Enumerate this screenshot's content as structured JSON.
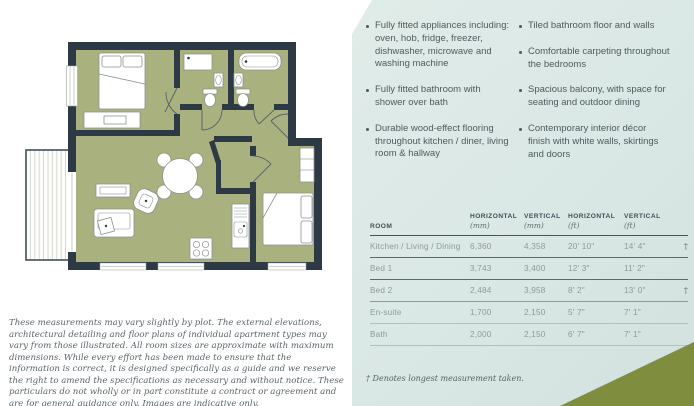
{
  "colors": {
    "panel_bg": "#dbe8e6",
    "olive_accent": "#7e8e3e",
    "wall": "#2d3944",
    "floor_green": "#a9b17e",
    "text_dark": "#4d5b5e",
    "text_muted": "#8d9a9a"
  },
  "panel": {
    "bullets_left": [
      "Fully fitted appliances including: oven, hob, fridge, freezer, dishwasher, microwave and washing machine",
      "Fully fitted bathroom with shower over bath",
      "Durable wood-effect flooring throughout kitchen / diner, living room & hallway"
    ],
    "bullets_right": [
      "Tiled bathroom floor and walls",
      "Comfortable carpeting throughout the bedrooms",
      "Spacious balcony, with space for seating and outdoor dining",
      "Contemporary interior décor finish with white walls, skirtings and doors"
    ],
    "table": {
      "headers": [
        {
          "label": "ROOM",
          "unit": ""
        },
        {
          "label": "HORIZONTAL",
          "unit": "(mm)"
        },
        {
          "label": "VERTICAL",
          "unit": "(mm)"
        },
        {
          "label": "HORIZONTAL",
          "unit": "(ft)"
        },
        {
          "label": "VERTICAL",
          "unit": "(ft)"
        }
      ],
      "rows": [
        {
          "room": "Kitchen / Living / Dining",
          "h_mm": "6,360",
          "v_mm": "4,358",
          "h_ft": "20' 10\"",
          "v_ft": "14' 4\"",
          "dagger": "†"
        },
        {
          "room": "Bed 1",
          "h_mm": "3,743",
          "v_mm": "3,400",
          "h_ft": "12' 3\"",
          "v_ft": "11' 2\"",
          "dagger": ""
        },
        {
          "room": "Bed 2",
          "h_mm": "2,484",
          "v_mm": "3,958",
          "h_ft": "8' 2\"",
          "v_ft": "13' 0\"",
          "dagger": "†"
        },
        {
          "room": "En-suite",
          "h_mm": "1,700",
          "v_mm": "2,150",
          "h_ft": "5' 7\"",
          "v_ft": "7' 1\"",
          "dagger": ""
        },
        {
          "room": "Bath",
          "h_mm": "2,000",
          "v_mm": "2,150",
          "h_ft": "6' 7\"",
          "v_ft": "7' 1\"",
          "dagger": ""
        }
      ]
    },
    "footnote": "† Denotes longest measurement taken."
  },
  "disclaimer": "These measurements may vary slightly by plot. The external elevations, architectural detailing and floor plans of individual apartment types may vary from those illustrated. All room sizes are approximate with maximum dimensions. While every effort has been made to ensure that the information is correct, it is designed specifically as a guide and we reserve the right to amend the specifications as necessary and without notice. These particulars do not wholly or in part constitute a contract or agreement and are for general guidance only. Images are indicative only.",
  "floorplan": {
    "elements": [
      "balcony",
      "bedroom-1-double-bed",
      "bedroom-1-wardrobe",
      "en-suite-shower",
      "en-suite-basin",
      "en-suite-toilet",
      "bathtub",
      "bathroom-basin",
      "bathroom-toilet",
      "dining-table-with-chairs",
      "sofa",
      "armchair",
      "sideboard",
      "kitchen-hob",
      "kitchen-sink-unit",
      "bedroom-2-double-bed",
      "bedroom-2-wardrobe",
      "windows",
      "door-swings"
    ]
  }
}
